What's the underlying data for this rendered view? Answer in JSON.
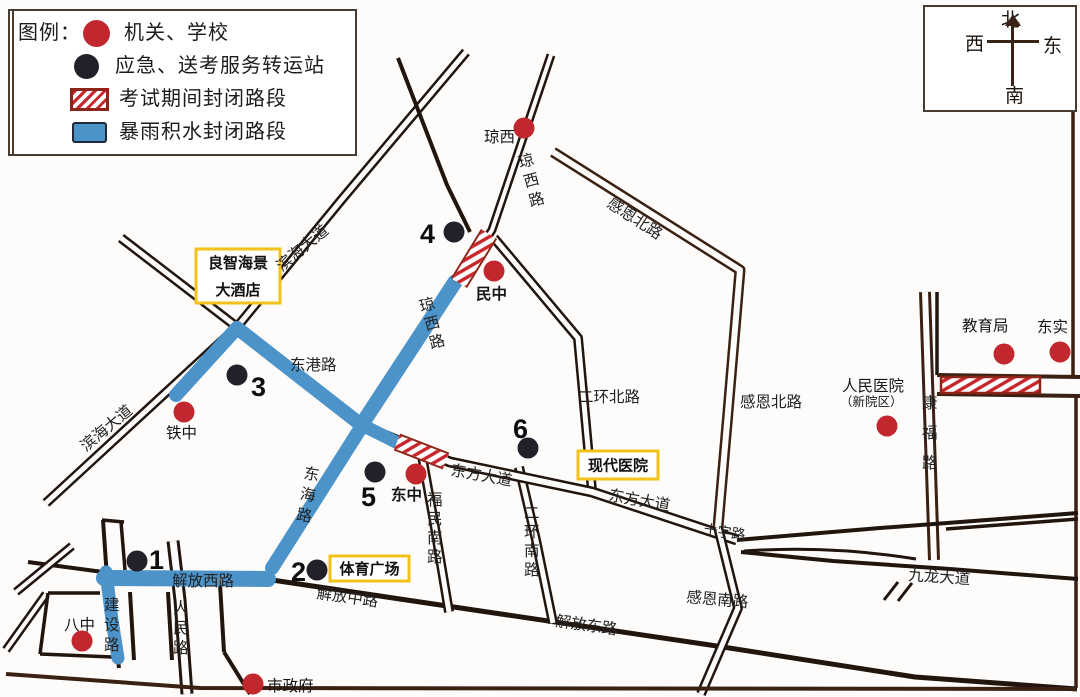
{
  "legend": {
    "title": "图例：",
    "items": [
      {
        "swatch": "red-dot",
        "label": "机关、学校"
      },
      {
        "swatch": "black-dot",
        "label": "应急、送考服务转运站"
      },
      {
        "swatch": "hatch",
        "label": "考试期间封闭路段"
      },
      {
        "swatch": "flood",
        "label": "暴雨积水封闭路段"
      }
    ]
  },
  "compass": {
    "north": "北",
    "south": "南",
    "east": "东",
    "west": "西"
  },
  "colors": {
    "road_dark": "#22150e",
    "road_brown": "#47291b",
    "flood_blue": "#4b93c9",
    "poi_red": "#c1272d",
    "station_black": "#23202a",
    "hatch_red": "#c9262c",
    "hatch_border": "#8e2418",
    "box_yellow": "#f2c218",
    "text": "#1c1c1c"
  },
  "map": {
    "width": 1080,
    "height": 697,
    "roads": [
      {
        "name": "滨海大道",
        "d": "M466,52 L343,198 L237,327 L46,503",
        "style": "double",
        "out": 10,
        "in": 5
      },
      {
        "name": "东港路",
        "d": "M121,238 L237,327 L362,426",
        "style": "double",
        "out": 10,
        "in": 5
      },
      {
        "name": "琼西路",
        "d": "M551,55 L492,230 L457,284 L362,426",
        "style": "double",
        "out": 9,
        "in": 4
      },
      {
        "name": "琼西路西线",
        "d": "M398,58 L447,185 L470,232",
        "style": "single",
        "w": 4
      },
      {
        "name": "东海路",
        "d": "M362,426 L271,570",
        "style": "double",
        "out": 10,
        "in": 5
      },
      {
        "name": "解放路",
        "d": "M100,578 L272,580 L710,645 L915,677 L1077,689",
        "style": "single",
        "w": 5
      },
      {
        "name": "解放西路西延",
        "d": "M28,562 L103,572",
        "style": "single",
        "w": 4
      },
      {
        "name": "建设路",
        "d": "M103,520 L107,578 L119,668",
        "style": "single",
        "w": 4
      },
      {
        "name": "人民路",
        "d": "M173,541 L180,600 L187,694",
        "style": "double",
        "out": 13,
        "in": 7
      },
      {
        "name": "福民南路",
        "d": "M421,450 L434,522 L449,612",
        "style": "double",
        "out": 10,
        "in": 5
      },
      {
        "name": "二环南路",
        "d": "M519,467 L536,540 L553,623",
        "style": "double",
        "out": 10,
        "in": 5
      },
      {
        "name": "二环北路",
        "d": "M494,238 L578,338 L592,491",
        "style": "double",
        "out": 10,
        "in": 5
      },
      {
        "name": "东方大道",
        "d": "M372,430 L450,462 L592,492 L737,540",
        "style": "double",
        "out": 11,
        "in": 6
      },
      {
        "name": "感恩北路",
        "d": "M553,152 L740,270 L728,412 L718,527",
        "style": "double",
        "out": 11,
        "in": 6,
        "color": "#3a2113"
      },
      {
        "name": "感恩南路",
        "d": "M718,527 L738,608 L701,694",
        "style": "double",
        "out": 10,
        "in": 5
      },
      {
        "name": "康福路",
        "d": "M925,292 L934,560",
        "style": "double",
        "out": 12,
        "in": 6,
        "color": "#3a2113"
      },
      {
        "name": "教育局块西缘",
        "d": "M937,292 L937,375",
        "style": "single",
        "w": 3.5
      },
      {
        "name": "康福路东横上",
        "d": "M937,375 L1080,377",
        "style": "single",
        "w": 4,
        "color": "#3a2113"
      },
      {
        "name": "康福路东横下",
        "d": "M937,394 L1080,396",
        "style": "single",
        "w": 4,
        "color": "#3a2113"
      },
      {
        "name": "东缘路北",
        "d": "M1073,110 L1073,375",
        "style": "single",
        "w": 3.5,
        "color": "#3a2113"
      },
      {
        "name": "东缘路南",
        "d": "M1076,396 L1076,688",
        "style": "single",
        "w": 3.5,
        "color": "#3a2113"
      },
      {
        "name": "九龙大道北缘",
        "d": "M737,540 L880,528 L1000,519 L1078,513",
        "style": "single",
        "w": 4
      },
      {
        "name": "九龙大道北缘2",
        "d": "M946,529 L1078,519",
        "style": "single",
        "w": 3.5
      },
      {
        "name": "九龙大道南缘",
        "d": "M741,552 L833,561 L950,569 L1078,579",
        "style": "single",
        "w": 4
      },
      {
        "name": "九龙大道内岛",
        "d": "M744,551 Q830,545 916,559",
        "style": "single",
        "w": 3
      },
      {
        "name": "左缘斜路1",
        "d": "M72,546 L16,592",
        "style": "double",
        "out": 9,
        "in": 4
      },
      {
        "name": "左缘斜路2",
        "d": "M46,594 L6,650",
        "style": "double",
        "out": 9,
        "in": 4
      },
      {
        "name": "八中块上",
        "d": "M48,593 L100,593",
        "style": "single",
        "w": 3.5
      },
      {
        "name": "八中块左",
        "d": "M48,593 L40,654",
        "style": "single",
        "w": 3.5
      },
      {
        "name": "八中块下",
        "d": "M40,654 L112,657",
        "style": "single",
        "w": 3.5
      },
      {
        "name": "建设路上横",
        "d": "M102,520 L124,522",
        "style": "single",
        "w": 3.5
      },
      {
        "name": "建设路东块",
        "d": "M121,522 L125,570",
        "style": "single",
        "w": 3.5
      },
      {
        "name": "中块西缘",
        "d": "M130,592 L134,660",
        "style": "single",
        "w": 4
      },
      {
        "name": "中块东缘",
        "d": "M168,592 L172,660",
        "style": "single",
        "w": 4
      },
      {
        "name": "人民路东块",
        "d": "M220,584 L224,652",
        "style": "single",
        "w": 4
      },
      {
        "name": "人民路东块斜",
        "d": "M224,652 L250,694",
        "style": "single",
        "w": 4
      },
      {
        "name": "南缘路",
        "d": "M6,674 L200,688 L1076,689",
        "style": "single",
        "w": 4,
        "color": "#3a2113"
      }
    ],
    "flooded_segments": [
      {
        "name": "滨海大道积水段",
        "d": "M176,395 L237,328",
        "w": 14
      },
      {
        "name": "东港路积水段",
        "d": "M237,328 L360,424",
        "w": 14
      },
      {
        "name": "琼西路积水段",
        "d": "M455,282 L362,424",
        "w": 15
      },
      {
        "name": "东海路积水段",
        "d": "M362,426 L272,568",
        "w": 14
      },
      {
        "name": "东方大道口积水",
        "d": "M368,428 L396,442",
        "w": 13
      },
      {
        "name": "解放西路积水段",
        "d": "M104,578 L268,579",
        "w": 16
      },
      {
        "name": "建设路积水段",
        "d": "M106,572 L112,620 L118,658",
        "w": 13
      }
    ],
    "closed_segments": [
      {
        "name": "琼西路封闭段",
        "d": "M489,234 L459,283",
        "w": 15
      },
      {
        "name": "东方大道封闭段",
        "d": "M397,442 L446,461",
        "w": 14
      }
    ],
    "closed_rects": [
      {
        "name": "康福路东封闭段",
        "x": 941,
        "y": 377,
        "w": 99,
        "h": 16
      }
    ],
    "road_labels": [
      {
        "text": "滨海大道",
        "x": 282,
        "y": 272,
        "rotate": -40
      },
      {
        "text": "滨海大道",
        "x": 86,
        "y": 452,
        "rotate": -40
      },
      {
        "text": "东港路",
        "x": 290,
        "y": 370,
        "rotate": 0
      },
      {
        "text": "解放西路",
        "x": 172,
        "y": 586,
        "rotate": 0
      },
      {
        "text": "解放中路",
        "x": 316,
        "y": 598,
        "rotate": 8
      },
      {
        "text": "解放东路",
        "x": 555,
        "y": 626,
        "rotate": 8
      },
      {
        "text": "东方大道",
        "x": 450,
        "y": 475,
        "rotate": 10
      },
      {
        "text": "东方大道",
        "x": 608,
        "y": 500,
        "rotate": 10
      },
      {
        "text": "十字路",
        "x": 703,
        "y": 534,
        "rotate": 8,
        "size": 14
      },
      {
        "text": "九龙大道",
        "x": 908,
        "y": 580,
        "rotate": 4
      },
      {
        "text": "感恩南路",
        "x": 686,
        "y": 602,
        "rotate": 5
      },
      {
        "text": "感恩北路",
        "x": 606,
        "y": 206,
        "rotate": 33
      },
      {
        "text": "感恩北路",
        "x": 740,
        "y": 407,
        "rotate": 0
      },
      {
        "text": "二环北路",
        "x": 578,
        "y": 402,
        "rotate": 0
      },
      {
        "text": "琼西路",
        "x": 520,
        "y": 168,
        "vertical": true,
        "spacing": 20,
        "rotate": -15
      },
      {
        "text": "琼西路",
        "x": 421,
        "y": 312,
        "vertical": true,
        "spacing": 19,
        "rotate": -15
      },
      {
        "text": "东海路",
        "x": 303,
        "y": 478,
        "vertical": true,
        "spacing": 21,
        "rotate": 10
      },
      {
        "text": "建设路",
        "x": 104,
        "y": 610,
        "vertical": true,
        "spacing": 20
      },
      {
        "text": "人民路",
        "x": 173,
        "y": 613,
        "vertical": true,
        "spacing": 20
      },
      {
        "text": "福民南路",
        "x": 427,
        "y": 505,
        "vertical": true,
        "spacing": 19
      },
      {
        "text": "二环南路",
        "x": 524,
        "y": 518,
        "vertical": true,
        "spacing": 19
      },
      {
        "text": "康福路",
        "x": 922,
        "y": 408,
        "vertical": true,
        "spacing": 30
      }
    ],
    "poi_labels": [
      {
        "text": "琼西",
        "x": 484,
        "y": 142
      },
      {
        "text": "铁中",
        "x": 166,
        "y": 438
      },
      {
        "text": "民中",
        "x": 476,
        "y": 299,
        "bold": true
      },
      {
        "text": "东中",
        "x": 391,
        "y": 500,
        "bold": true
      },
      {
        "text": "八中",
        "x": 64,
        "y": 630
      },
      {
        "text": "市政府",
        "x": 267,
        "y": 691
      },
      {
        "text": "教育局",
        "x": 962,
        "y": 331
      },
      {
        "text": "东实",
        "x": 1037,
        "y": 332
      },
      {
        "text": "人民医院",
        "x": 842,
        "y": 391
      },
      {
        "text": "（新院区）",
        "x": 840,
        "y": 406,
        "size": 12.5
      }
    ],
    "boxed_labels": [
      {
        "name": "良智海景大酒店",
        "x": 196,
        "y": 249,
        "w": 84,
        "h": 54,
        "lines": [
          "良智海景",
          "大酒店"
        ]
      },
      {
        "name": "现代医院",
        "x": 578,
        "y": 451,
        "w": 80,
        "h": 28,
        "lines": [
          "现代医院"
        ]
      },
      {
        "name": "体育广场",
        "x": 330,
        "y": 556,
        "w": 79,
        "h": 25,
        "lines": [
          "体育广场"
        ]
      }
    ],
    "red_dots": [
      {
        "x": 524,
        "y": 128,
        "near": "琼西"
      },
      {
        "x": 494,
        "y": 271,
        "near": "民中"
      },
      {
        "x": 184,
        "y": 412,
        "near": "铁中"
      },
      {
        "x": 416,
        "y": 474,
        "near": "东中"
      },
      {
        "x": 82,
        "y": 641,
        "near": "八中"
      },
      {
        "x": 253,
        "y": 684,
        "near": "市政府"
      },
      {
        "x": 1004,
        "y": 354,
        "near": "教育局"
      },
      {
        "x": 1060,
        "y": 352,
        "near": "东实"
      },
      {
        "x": 887,
        "y": 426,
        "near": "人民医院"
      }
    ],
    "black_dots": [
      {
        "number": "1",
        "x": 137,
        "y": 561,
        "nx": 149,
        "ny": 569
      },
      {
        "number": "2",
        "x": 317,
        "y": 570,
        "nx": 291,
        "ny": 581
      },
      {
        "number": "3",
        "x": 237,
        "y": 375,
        "nx": 251,
        "ny": 396
      },
      {
        "number": "4",
        "x": 454,
        "y": 232,
        "nx": 420,
        "ny": 243
      },
      {
        "number": "5",
        "x": 375,
        "y": 472,
        "nx": 361,
        "ny": 506
      },
      {
        "number": "6",
        "x": 528,
        "y": 448,
        "nx": 513,
        "ny": 438
      }
    ]
  }
}
